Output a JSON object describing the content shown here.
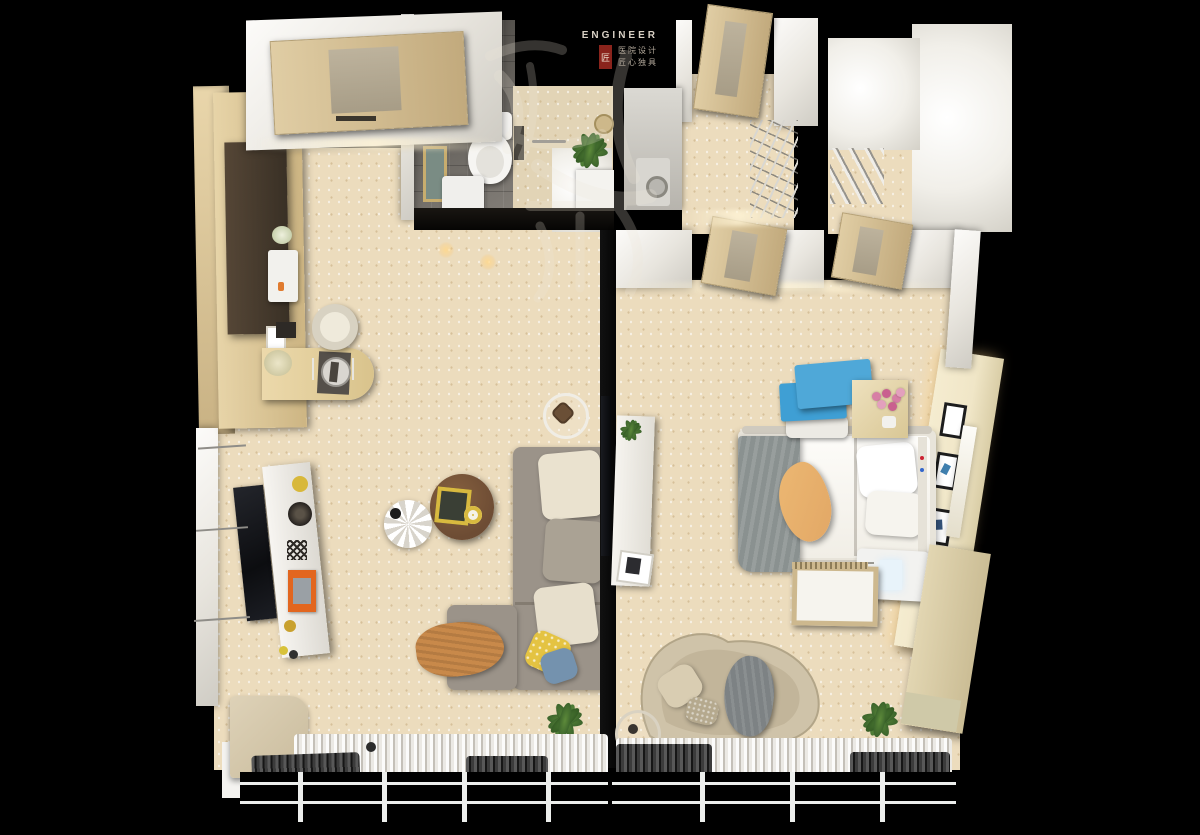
{
  "meta": {
    "kind": "3d-rendered-floorplan",
    "view": "top-down dollhouse render",
    "canvas": "1200x835"
  },
  "logo": {
    "brand": "ENGINEER",
    "tagline_line1": "医院设计",
    "tagline_line2": "匠心独具",
    "seal_char": "匠",
    "watermark_calligraphy": "殹西匠"
  },
  "palette": {
    "bg": "#000000",
    "floor": "#ecdcbd",
    "tile-gray": "#76716a",
    "wood-light": "#e3cfa2",
    "sofa-gray": "#9b9389",
    "cushion-cream": "#eae2cf",
    "pillow-yellow": "#e4c342",
    "pillow-blue": "#7492ae",
    "throw-orange": "#c8894a",
    "coffee-wood": "#6d4c34",
    "accent-blue": "#4fa8d8",
    "overbed-orange": "#e2a765",
    "blanket-gray": "#8a9190",
    "chaise-beige": "#cfc3a9",
    "headboard-cream": "#f0e6c7",
    "seal-red": "#8a241c"
  },
  "rooms": [
    {
      "name": "living-dining-room",
      "items": [
        "wood sideboard counter",
        "dark wall cabinet",
        "water dispenser",
        "flower pot",
        "photo frame",
        "dining table with place setting",
        "tub chair",
        "bouquet",
        "wall TV",
        "white media console",
        "yellow vase",
        "black bowl",
        "orange box",
        "round wood coffee table",
        "yellow tray",
        "yellow mug",
        "white flower lamp",
        "tripod floor lamp",
        "L-shaped gray sectional sofa",
        "cream cushions",
        "yellow polka-dot pillow",
        "blue pillow",
        "orange throw blanket",
        "potted plant",
        "window seat",
        "sheer curtain",
        "dark curtain",
        "window"
      ]
    },
    {
      "name": "bedroom-patient-room",
      "items": [
        "bed with side rails",
        "white bedding",
        "pillows",
        "gray blanket",
        "wood overbed tray",
        "blue adjustable overbed table",
        "bedside cabinet",
        "pink flowers",
        "backlit headboard panel",
        "three framed prints",
        "bedside control strip",
        "medical unit with display",
        "wood slat bench",
        "wall console shelf",
        "small plant",
        "photo frame",
        "curved chaise lounge",
        "beige pillows",
        "gray throw",
        "ring floor lamp",
        "potted plant",
        "wardrobe",
        "sheer curtain",
        "dark curtain",
        "window"
      ]
    },
    {
      "name": "bathroom",
      "items": [
        "toilet",
        "washer cabinet",
        "wall art",
        "glass partition",
        "towel bar",
        "round mirror",
        "plant",
        "vanity"
      ]
    },
    {
      "name": "entry-hall",
      "items": [
        "entry door",
        "coat and shoe rack"
      ]
    },
    {
      "name": "utility-room",
      "items": [
        "washing machine"
      ]
    },
    {
      "name": "stair-corridor",
      "items": [
        "stair railing",
        "bright stairwell"
      ]
    }
  ]
}
